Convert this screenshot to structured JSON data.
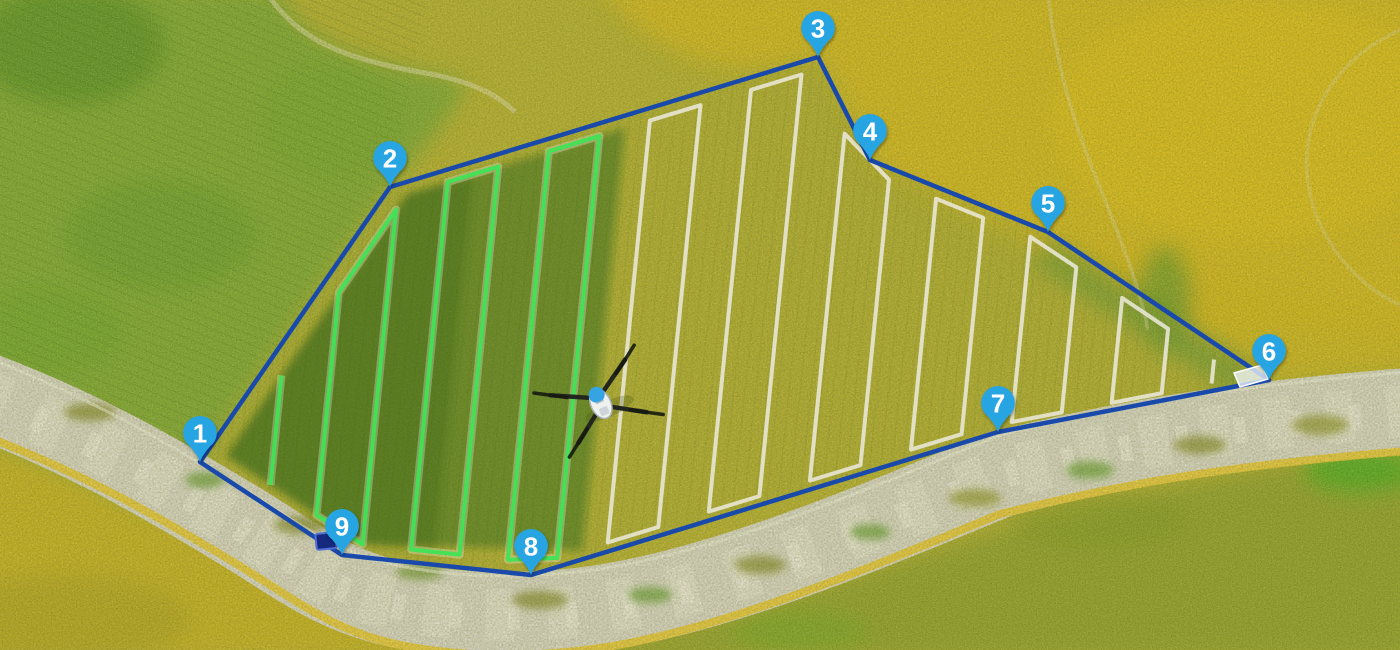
{
  "scene": {
    "width": 1400,
    "height": 650,
    "kind": "aerial-field-map-with-flight-plan"
  },
  "colors": {
    "boundary_line": "#1949aa",
    "completed_path": "#3fe455",
    "planned_path": "#ebe8d8",
    "marker_fill": "#27a5e2",
    "marker_text": "#ffffff",
    "sprayed_overlay": "#1e5c14"
  },
  "waypoints": [
    {
      "label": "1",
      "x": 200,
      "y": 462
    },
    {
      "label": "2",
      "x": 390,
      "y": 187
    },
    {
      "label": "3",
      "x": 818,
      "y": 57
    },
    {
      "label": "4",
      "x": 870,
      "y": 160
    },
    {
      "label": "5",
      "x": 1048,
      "y": 232
    },
    {
      "label": "6",
      "x": 1269,
      "y": 380
    },
    {
      "label": "7",
      "x": 998,
      "y": 432
    },
    {
      "label": "8",
      "x": 531,
      "y": 575
    },
    {
      "label": "9",
      "x": 342,
      "y": 555
    }
  ],
  "route": {
    "style": "paired-lane-loops",
    "first_lane_x": 230,
    "lane_spacing": 49,
    "lane_slope": -0.1,
    "base_y": 400,
    "lane_count": 22,
    "completed_lane_count": 8,
    "boundary_inset_scale": 0.95
  },
  "drone": {
    "x": 600,
    "y": 402,
    "heading_deg": -25
  },
  "home_point": {
    "x": 326,
    "y": 541
  },
  "landing_pad": {
    "x": 1250,
    "y": 376
  }
}
